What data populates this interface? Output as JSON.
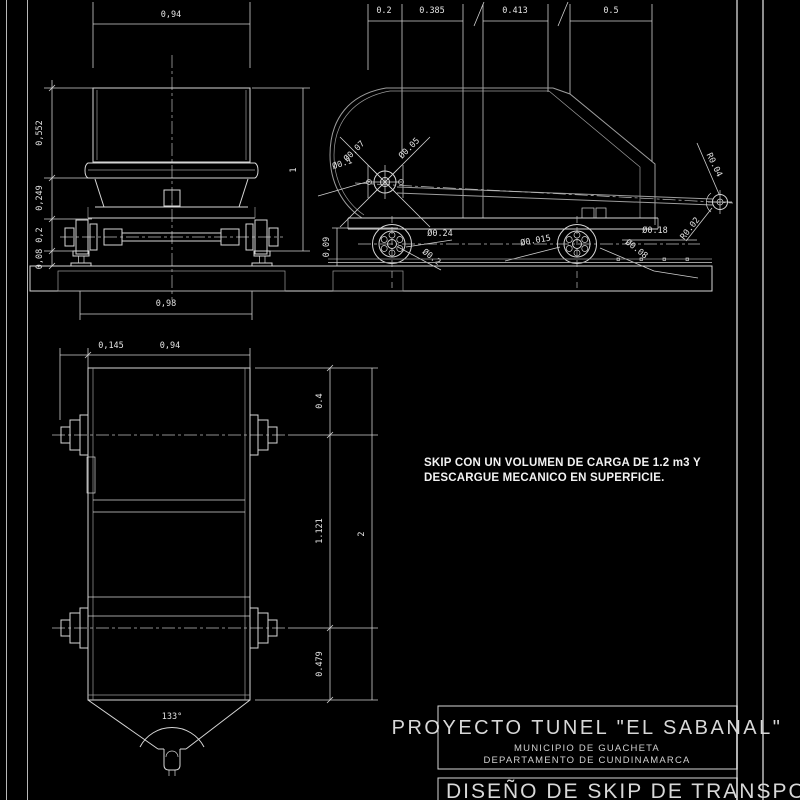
{
  "front_view": {
    "width": "0,94",
    "heights": {
      "h1": "0,552",
      "h2": "0,249",
      "h3": "0,2",
      "h4": "0,08"
    },
    "total_height": "1",
    "rail_gauge": "0,98"
  },
  "side_view": {
    "top_dims": {
      "d1": "0.2",
      "d2": "0.385",
      "d3": "0.413",
      "d4": "0.5"
    },
    "rail_height": "0,09",
    "diameters": {
      "hub_outer": "Ø0.07",
      "hub_pin": "Ø0.05",
      "hub_shaft": "Ø0.1",
      "wheel_front": "Ø0.24",
      "axle_front": "Ø0.2",
      "pin_rear": "Ø0.015",
      "wheel_rear": "Ø0.18",
      "axle_rear": "Ø0.08"
    },
    "radii": {
      "hook_outer": "R0.04",
      "hook_inner": "R0.02"
    }
  },
  "plan_view": {
    "hub_offset": "0,145",
    "body_width": "0,94",
    "lengths": {
      "front": "0.4",
      "middle": "1.121",
      "rear": "0.479"
    },
    "total_length": "2",
    "tip_angle": "133°"
  },
  "note": {
    "line1": "SKIP CON UN VOLUMEN DE CARGA DE 1.2 m3 Y",
    "line2": "DESCARGUE MECANICO EN SUPERFICIE."
  },
  "title_block": {
    "project": "PROYECTO TUNEL \"EL SABANAL\"",
    "municipality": "MUNICIPIO DE GUACHETA",
    "department": "DEPARTAMENTO DE CUNDINAMARCA",
    "drawing_title": "DISEÑO DE SKIP DE TRANSPORTE"
  }
}
